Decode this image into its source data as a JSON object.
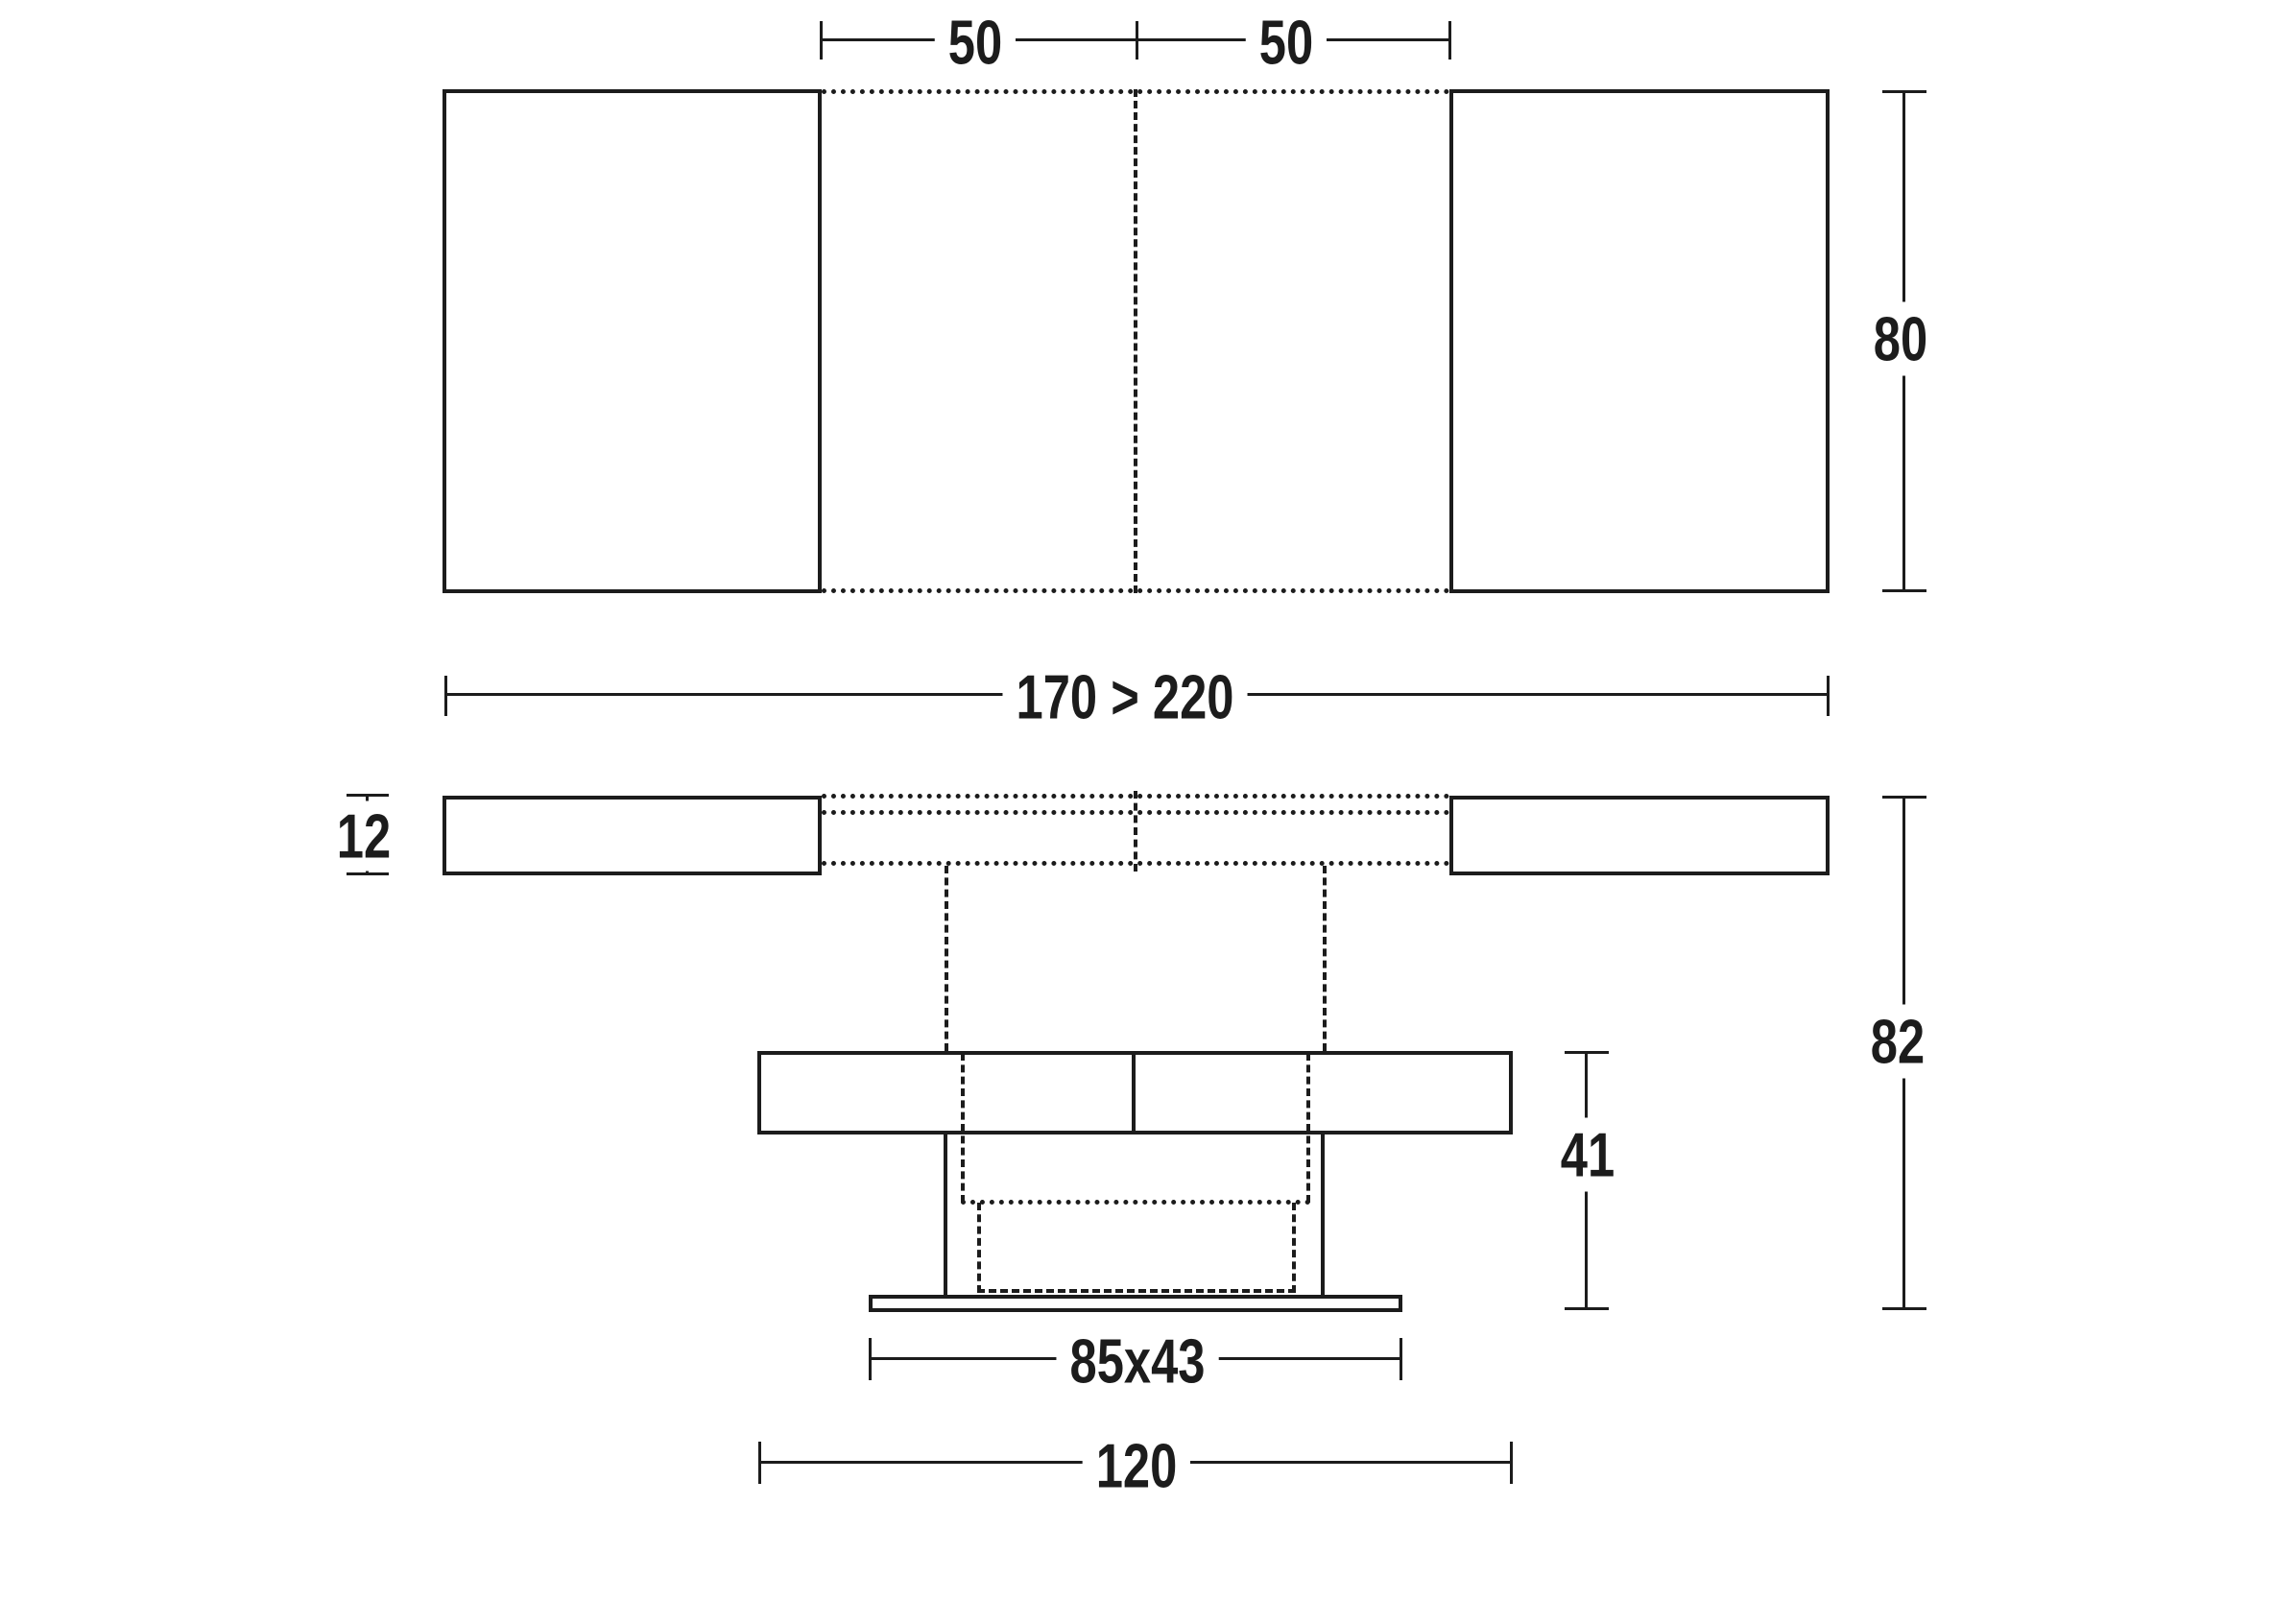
{
  "diagram": {
    "background": "#ffffff",
    "line_color": "#1c1c1c",
    "views": {
      "top_view": "table top seen from above with two extension leaves",
      "side_view": "table seen from the side with telescoping pedestal"
    }
  },
  "dims": {
    "leaf_left": "50",
    "leaf_right": "50",
    "depth": "80",
    "length_range": "170 > 220",
    "top_thickness": "12",
    "height_open": "82",
    "height_closed": "41",
    "base_footprint": "85x43",
    "base_width": "120"
  }
}
